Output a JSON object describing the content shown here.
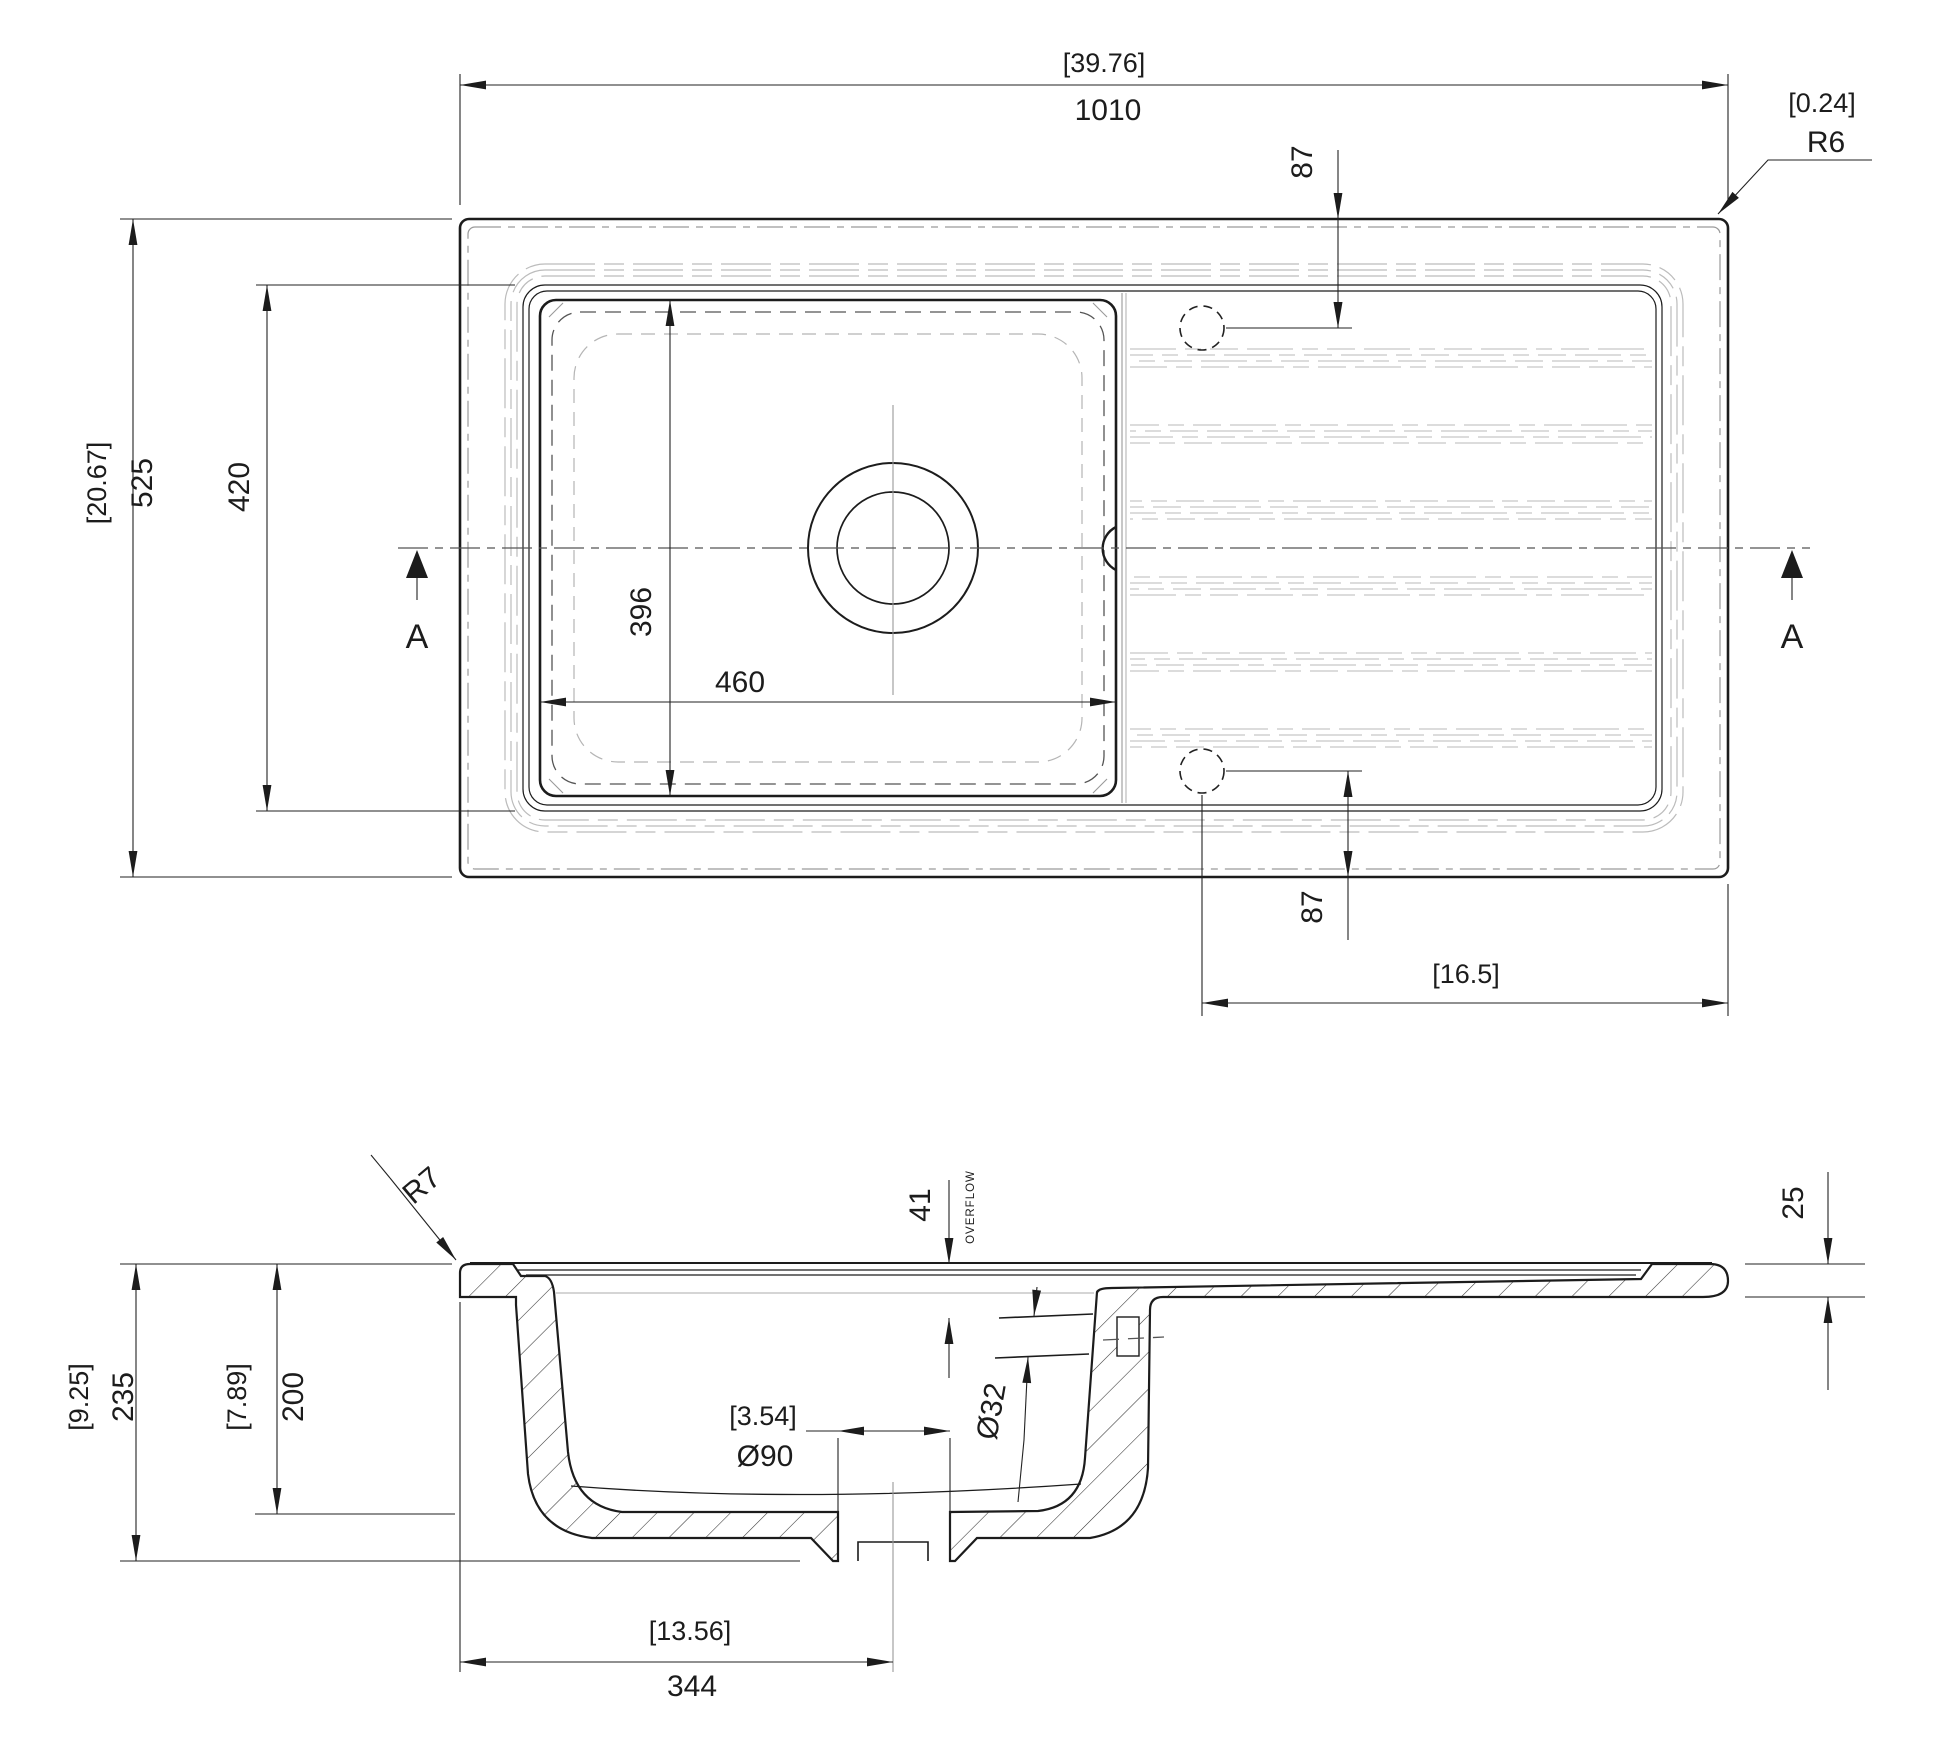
{
  "drawing": {
    "type": "sink-technical-drawing",
    "colors": {
      "line": "#1c1c1c",
      "light_gray": "#bcbcbc",
      "centerline": "#555555"
    },
    "top_view": {
      "overall_width": {
        "inches": "[39.76]",
        "mm": "1010"
      },
      "overall_depth": {
        "inches": "[20.67]",
        "mm": "525"
      },
      "corner_radius": {
        "inches": "[0.24]",
        "label": "R6"
      },
      "recess_depth_mm": "420",
      "bowl_depth_mm": "396",
      "bowl_width_mm": "460",
      "tap_hole_offset_top_mm": "87",
      "tap_hole_offset_bottom_mm": "87",
      "drainer_offset_inches": "[16.5]",
      "section_marker_left": "A",
      "section_marker_right": "A"
    },
    "side_view": {
      "overall_height": {
        "inches": "[9.25]",
        "mm": "235"
      },
      "bowl_inner_height": {
        "inches": "[7.89]",
        "mm": "200"
      },
      "drain_center_offset": {
        "inches": "[13.56]",
        "mm": "344"
      },
      "deck_thickness_mm": "25",
      "overflow_offset_mm": "41",
      "overflow_label": "OVERFLOW",
      "overflow_diameter": "Ø32",
      "drain_diameter": {
        "inches": "[3.54]",
        "label": "Ø90"
      },
      "rim_radius": "R7"
    }
  }
}
